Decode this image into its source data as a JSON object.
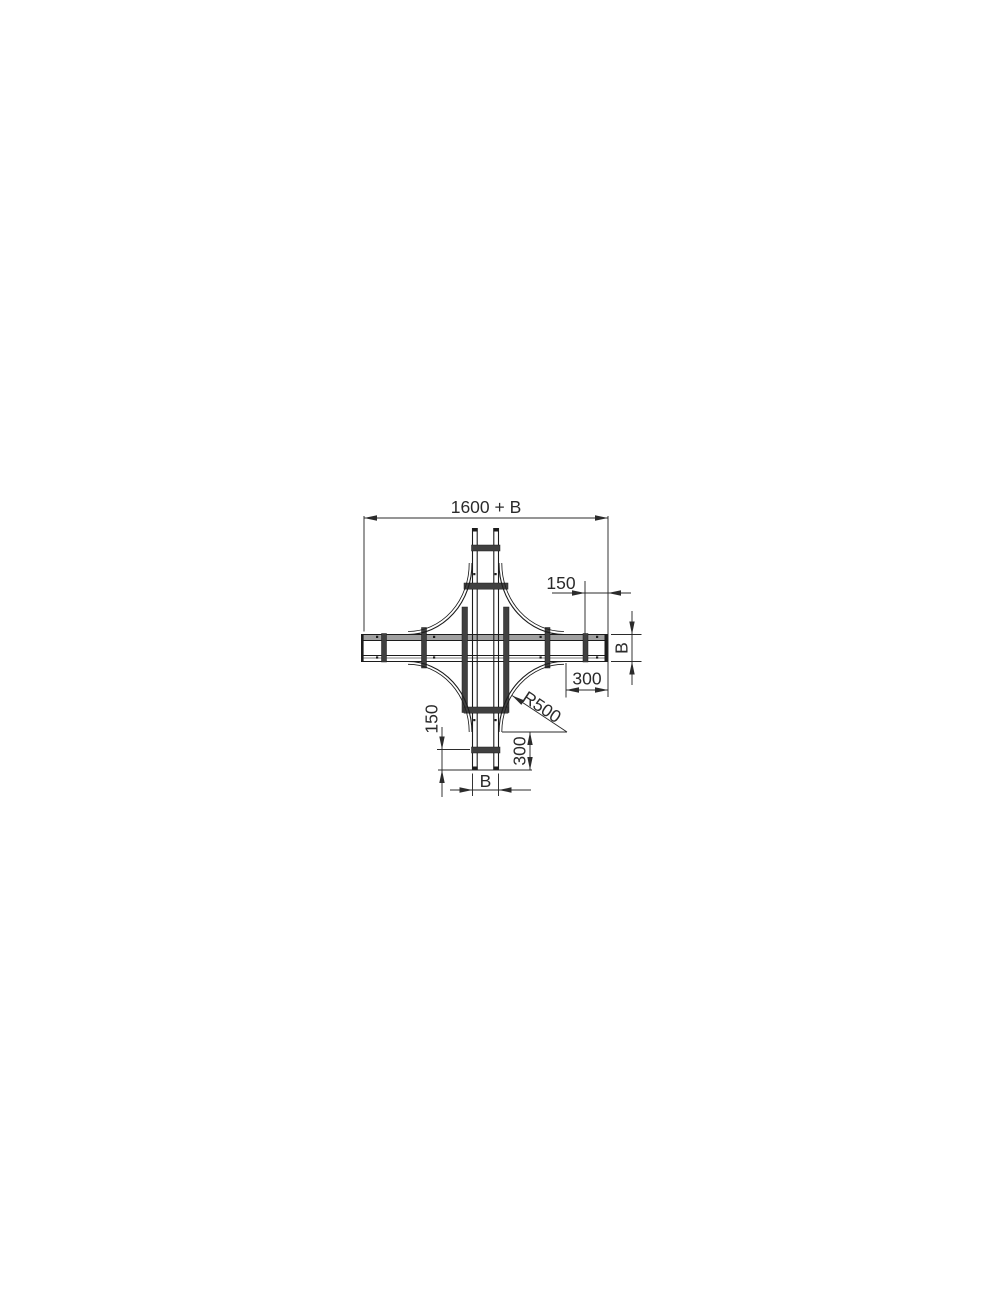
{
  "colors": {
    "line": "#1c1c1c",
    "dim": "#2b2b2b",
    "rail-fill": "#a0a0a0",
    "rung-fill": "#404040",
    "bg": "#ffffff"
  },
  "dims": {
    "overall_width": "1600 + B",
    "right_end_offset": "150",
    "right_width": "B",
    "right_straight": "300",
    "corner_radius": "R500",
    "bottom_end_offset": "150",
    "bottom_straight": "300",
    "bottom_width": "B"
  }
}
